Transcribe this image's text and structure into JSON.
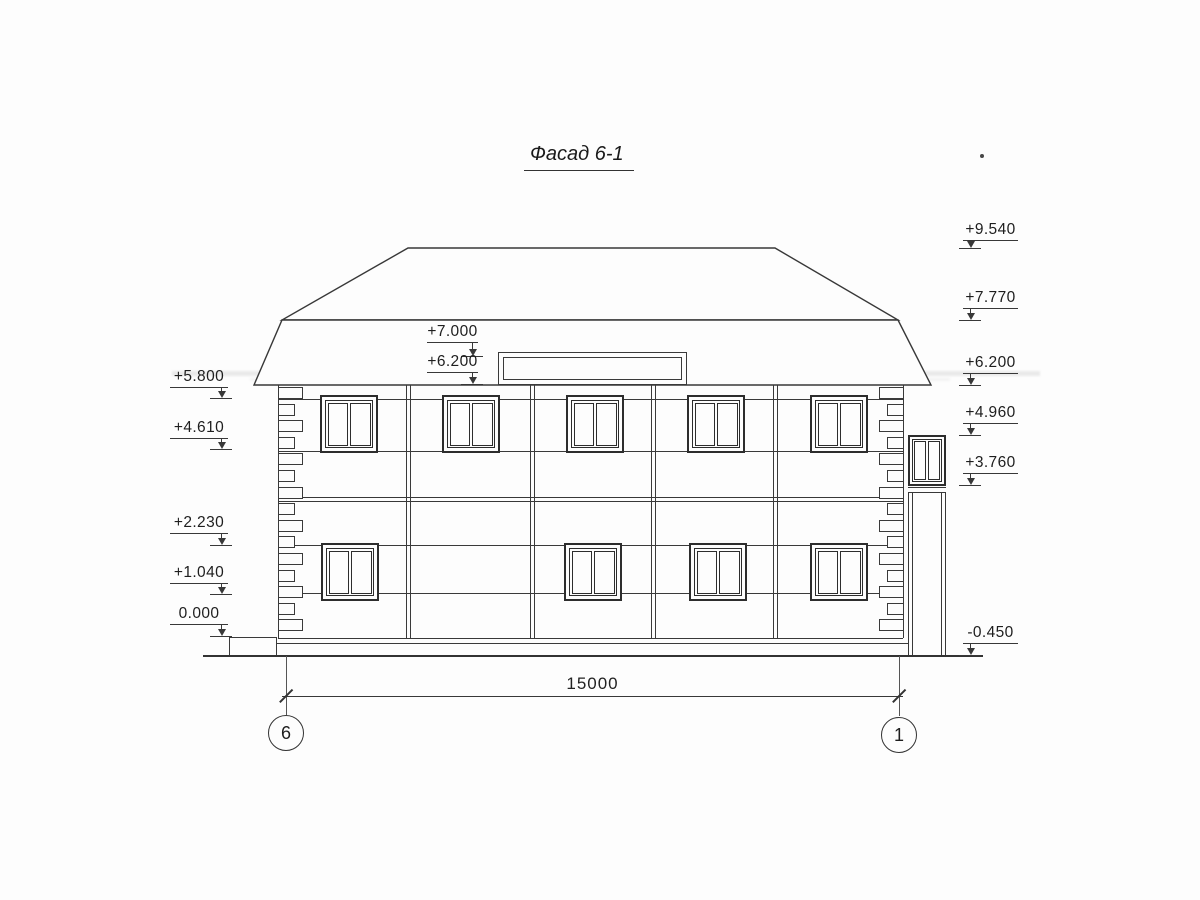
{
  "title": "Фасад 6-1",
  "dimension": {
    "value": "15000"
  },
  "axes": [
    {
      "label": "6",
      "x": 286
    },
    {
      "label": "1",
      "x": 899
    }
  ],
  "elevation_markers": [
    {
      "label": "+5.800",
      "side": "left",
      "line_x": 170,
      "line_w": 58,
      "arrow_x": 221,
      "line_y": 387,
      "tip_y": 398
    },
    {
      "label": "+4.610",
      "side": "left",
      "line_x": 170,
      "line_w": 58,
      "arrow_x": 221,
      "line_y": 438,
      "tip_y": 449
    },
    {
      "label": "+2.230",
      "side": "left",
      "line_x": 170,
      "line_w": 58,
      "arrow_x": 221,
      "line_y": 533,
      "tip_y": 545
    },
    {
      "label": "+1.040",
      "side": "left",
      "line_x": 170,
      "line_w": 58,
      "arrow_x": 221,
      "line_y": 583,
      "tip_y": 594
    },
    {
      "label": "0.000",
      "side": "left",
      "line_x": 170,
      "line_w": 58,
      "arrow_x": 221,
      "line_y": 624,
      "tip_y": 636
    },
    {
      "label": "+7.000",
      "side": "middle",
      "line_x": 427,
      "line_w": 51,
      "arrow_x": 472,
      "line_y": 342,
      "tip_y": 356
    },
    {
      "label": "+6.200",
      "side": "middle",
      "line_x": 427,
      "line_w": 51,
      "arrow_x": 472,
      "line_y": 372,
      "tip_y": 384
    },
    {
      "label": "+9.540",
      "side": "right",
      "line_x": 963,
      "line_w": 55,
      "arrow_x": 970,
      "line_y": 240,
      "tip_y": 248
    },
    {
      "label": "+7.770",
      "side": "right",
      "line_x": 963,
      "line_w": 55,
      "arrow_x": 970,
      "line_y": 308,
      "tip_y": 320
    },
    {
      "label": "+6.200",
      "side": "right",
      "line_x": 963,
      "line_w": 55,
      "arrow_x": 970,
      "line_y": 373,
      "tip_y": 385
    },
    {
      "label": "+4.960",
      "side": "right",
      "line_x": 963,
      "line_w": 55,
      "arrow_x": 970,
      "line_y": 423,
      "tip_y": 435
    },
    {
      "label": "+3.760",
      "side": "right",
      "line_x": 963,
      "line_w": 55,
      "arrow_x": 970,
      "line_y": 473,
      "tip_y": 485
    },
    {
      "label": "-0.450",
      "side": "right",
      "line_x": 963,
      "line_w": 55,
      "arrow_x": 970,
      "line_y": 643,
      "tip_y": 655
    }
  ],
  "facade": {
    "wall": {
      "left": 278,
      "right": 903,
      "top": 385,
      "bottom": 638
    },
    "windows_upper_x": [
      320,
      442,
      566,
      687,
      810
    ],
    "windows_lower_x": [
      321,
      564,
      689,
      810
    ],
    "window_y_upper": 395,
    "window_y_lower": 543,
    "window_w": 58,
    "window_h": 58,
    "pilasters_x": [
      406,
      530,
      651,
      773
    ],
    "quoins": {
      "rows": 15,
      "start_y": 387,
      "pitch": 16.6,
      "long_w": 25,
      "short_w": 17
    }
  },
  "colors": {
    "line": "#383838",
    "paper": "#fdfdfd",
    "text": "#1e1e1e"
  }
}
